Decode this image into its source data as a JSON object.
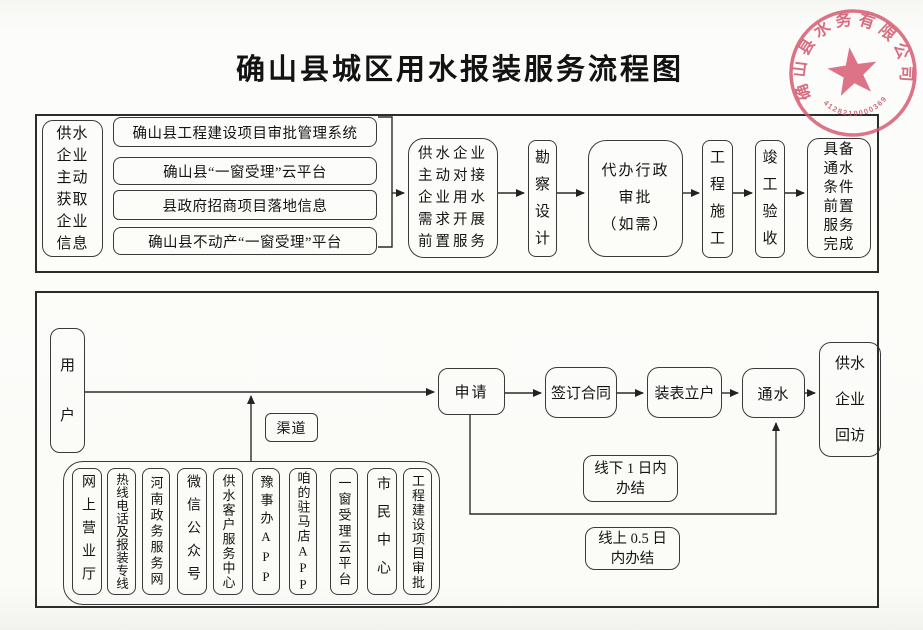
{
  "title": "确山县城区用水报装服务流程图",
  "seal": {
    "company": "确山县水务有限公司",
    "number": "4128210000369"
  },
  "top": {
    "source": "供水\n企业\n主动\n获取\n企业\n信息",
    "platforms": [
      "确山县工程建设项目审批管理系统",
      "确山县“一窗受理”云平台",
      "县政府招商项目落地信息",
      "确山县不动产“一窗受理”平台"
    ],
    "dock": "供水企业\n主动对接\n企业用水\n需求开展\n前置服务",
    "survey": "勘\n察\n设\n计",
    "approval": "代办行政\n审批\n（如需）",
    "construction": "工\n程\n施\n工",
    "acceptance": "竣\n工\n验\n收",
    "complete": "具备\n通水\n条件\n前置\n服务\n完成"
  },
  "bottom": {
    "user": "用\n户",
    "channel_label": "渠道",
    "apply": "申请",
    "contract": "签订合同",
    "meter": "装表立户",
    "water_on": "通水",
    "visit": "供水\n企业\n回访",
    "offline_sla": "线下 1 日内\n办结",
    "online_sla": "线上 0.5 日\n内办结",
    "channels": [
      "网上营业厅",
      "热线电话及报装专线",
      "河南政务服务网",
      "微信公众号",
      "供水客户服务中心",
      "豫事办APP",
      "咱的驻马店APP",
      "一窗受理云平台",
      "市民中心",
      "工程建设项目审批"
    ]
  }
}
